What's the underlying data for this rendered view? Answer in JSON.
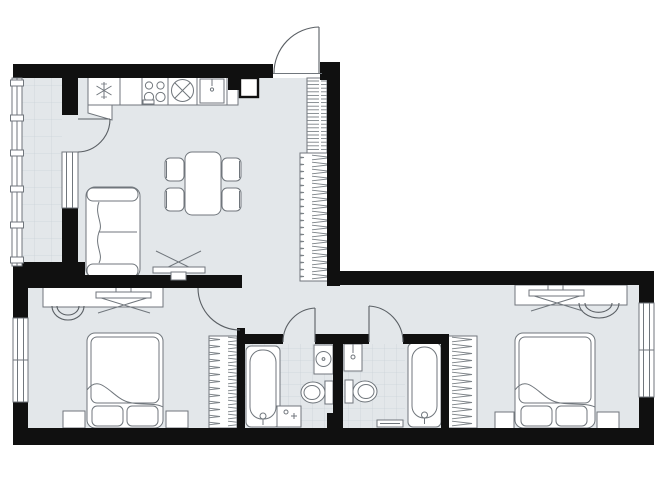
{
  "colors": {
    "wall": "#101010",
    "floor": "#e3e7ea",
    "tile": "#ccd3d9",
    "outline": "#70767c",
    "hatch": "#7c8287",
    "door": "#5a5f64",
    "bg": "#ffffff",
    "furn": "#ffffff"
  },
  "plan": {
    "type": "two-bedroom apartment floor plan",
    "rooms": [
      {
        "name": "balcony",
        "features": [
          "glazed-facade",
          "tiled-floor"
        ]
      },
      {
        "name": "kitchen-living-room",
        "features": [
          "refrigerator",
          "kitchen-counter",
          "cooktop-4-burner",
          "round-sink",
          "sink-cabinet",
          "corner-cabinet",
          "vent-shaft",
          "dining-table",
          "four-chairs",
          "sofa",
          "wall-tv",
          "shelving-unit",
          "wardrobe"
        ]
      },
      {
        "name": "hallway",
        "features": [
          "open-passage"
        ]
      },
      {
        "name": "bedroom-1",
        "features": [
          "double-bed",
          "two-pillows",
          "two-nightstands",
          "desk-with-tv",
          "chair",
          "wardrobe",
          "window"
        ]
      },
      {
        "name": "bathroom-1",
        "features": [
          "bathtub",
          "washbasin",
          "toilet",
          "washing-machine",
          "vent-shaft",
          "tiled-floor"
        ]
      },
      {
        "name": "bathroom-2",
        "features": [
          "bathtub",
          "washbasin",
          "toilet",
          "bath-mat",
          "tiled-floor"
        ]
      },
      {
        "name": "bedroom-2",
        "features": [
          "double-bed",
          "two-pillows",
          "two-nightstands",
          "desk-with-tv",
          "chair",
          "wardrobe",
          "window"
        ]
      }
    ],
    "doors": [
      "entrance-door",
      "balcony-door",
      "bedroom-1-door",
      "bathroom-1-door",
      "bathroom-2-door"
    ],
    "windows": [
      "balcony-glazing",
      "living-room-balcony-window",
      "bedroom-1-window",
      "bedroom-2-window"
    ]
  }
}
